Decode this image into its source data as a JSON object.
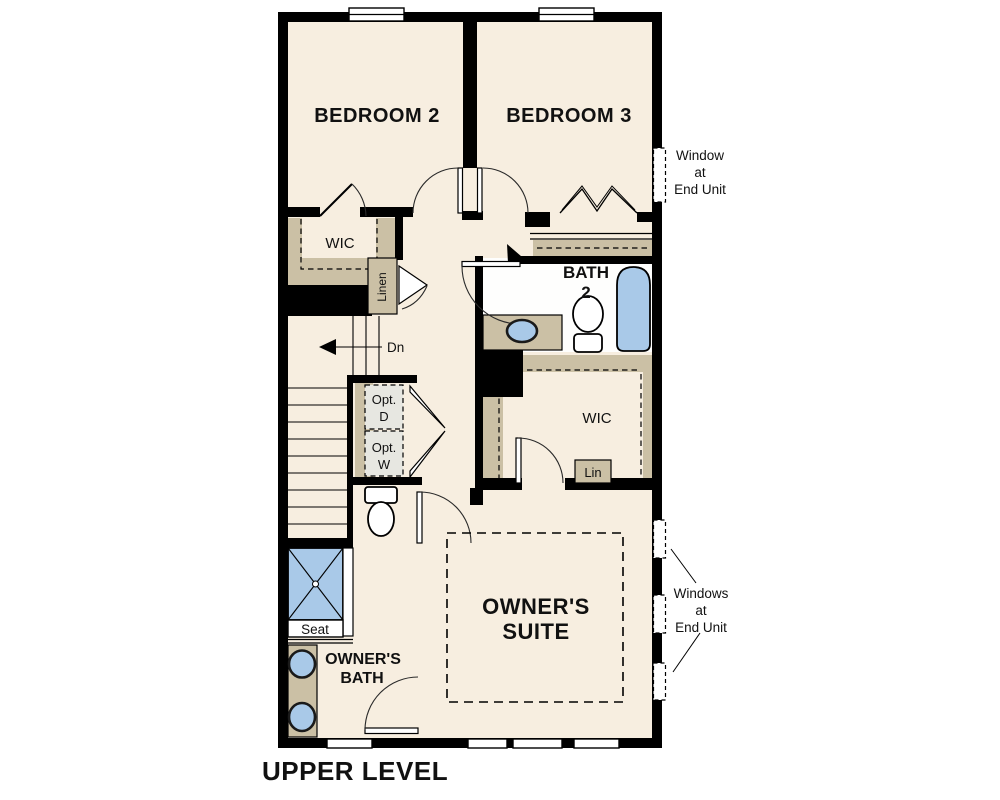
{
  "title": "UPPER LEVEL",
  "colors": {
    "floor": "#F7EEE0",
    "wall": "#000000",
    "cabinet": "#CBC0A5",
    "fixture_blue": "#A9C9E8",
    "bath_floor": "#FEFEFD",
    "opt_fill": "#E7E7E1",
    "text": "#111111"
  },
  "rooms": {
    "bedroom2": "BEDROOM 2",
    "bedroom3": "BEDROOM 3",
    "wic_bedroom2": "WIC",
    "linen": "Linen",
    "bath2_line1": "BATH",
    "bath2_line2": "2",
    "stair_direction": "Dn",
    "opt_dryer_line1": "Opt.",
    "opt_dryer_line2": "D",
    "opt_washer_line1": "Opt.",
    "opt_washer_line2": "W",
    "wic_owner": "WIC",
    "lin_closet": "Lin",
    "owners_suite_line1": "OWNER'S",
    "owners_suite_line2": "SUITE",
    "shower_seat": "Seat",
    "owners_bath_line1": "OWNER'S",
    "owners_bath_line2": "BATH"
  },
  "annotations": {
    "window_top": {
      "lines": [
        "Window",
        "at",
        "End Unit"
      ]
    },
    "windows_bottom": {
      "lines": [
        "Windows",
        "at",
        "End Unit"
      ]
    }
  }
}
